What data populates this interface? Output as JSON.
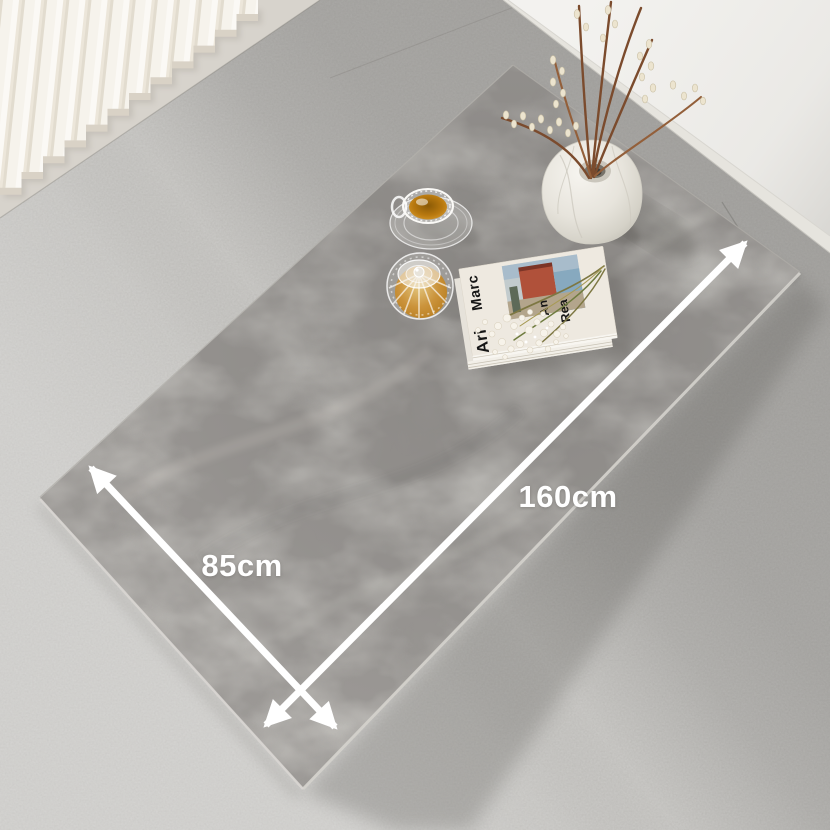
{
  "annotations": {
    "length_label": "160cm",
    "width_label": "85cm"
  },
  "magazine": {
    "cover_texts": {
      "left_top": "Marc",
      "left_bottom": "Ari",
      "right_upper": "An",
      "right_lower": "Rea"
    }
  },
  "colors": {
    "arrow": "#ffffff",
    "tabletop": "#9a9794",
    "floor": "#c8c7c4",
    "wall": "#f3f2ef",
    "baseboard": "#e6e4de",
    "tea": "#b9790f",
    "blinds": "#f4f1ea",
    "vase": "#ece9e2",
    "branches": "#7b4b2d"
  },
  "objects": [
    "dining-table",
    "marble-vase",
    "pussy-willow-branches",
    "glass-teacup",
    "glass-teapot",
    "magazine-stack",
    "babys-breath-flowers",
    "vertical-blinds",
    "dimension-arrows"
  ]
}
